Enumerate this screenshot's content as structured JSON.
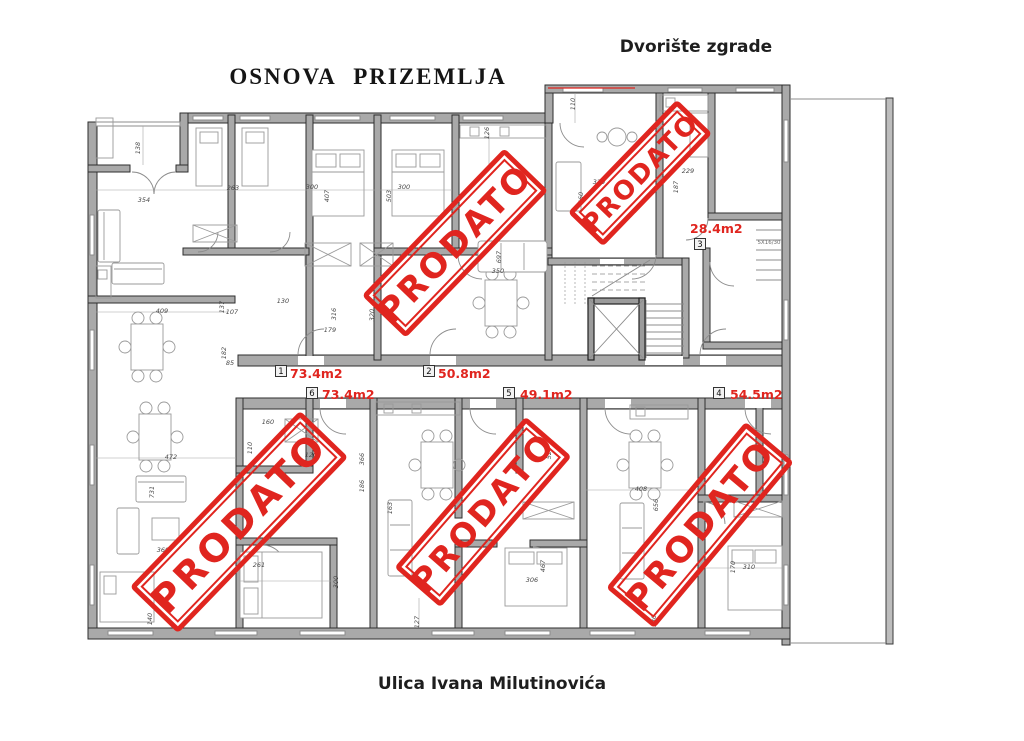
{
  "title": "OSNOVA PRIZEMLJA",
  "courtyard_label": "Dvorište zgrade",
  "street_label": "Ulica Ivana Milutinovića",
  "stamp_text": "PRODATO",
  "stair_note": "5X16/30",
  "colors": {
    "red": "#e0251f",
    "wall": "#a9a9a9",
    "wall_stroke": "#2e2e2e",
    "line": "#8c8c8c",
    "dim_text": "#4a4a4a"
  },
  "apartments": [
    {
      "num": "1",
      "area": "73.4m2",
      "sold": false,
      "box_x": 281,
      "box_y": 371,
      "text_x": 290,
      "text_y": 378
    },
    {
      "num": "2",
      "area": "50.8m2",
      "sold": true,
      "box_x": 429,
      "box_y": 371,
      "text_x": 438,
      "text_y": 378
    },
    {
      "num": "3",
      "area": "28.4m2",
      "sold": true,
      "box_x": 700,
      "box_y": 244,
      "text_x": 690,
      "text_y": 233
    },
    {
      "num": "4",
      "area": "54.5m2",
      "sold": true,
      "box_x": 719,
      "box_y": 393,
      "text_x": 730,
      "text_y": 399
    },
    {
      "num": "5",
      "area": "49.1m2",
      "sold": true,
      "box_x": 509,
      "box_y": 393,
      "text_x": 520,
      "text_y": 399
    },
    {
      "num": "6",
      "area": "73.4m2",
      "sold": true,
      "box_x": 312,
      "box_y": 393,
      "text_x": 322,
      "text_y": 399
    }
  ],
  "stamps": [
    {
      "apartment": "2",
      "x": 455,
      "y": 243,
      "rot": -46,
      "w": 200,
      "h": 56,
      "font": 34,
      "ls": 3
    },
    {
      "apartment": "3",
      "x": 640,
      "y": 173,
      "rot": -46,
      "w": 152,
      "h": 44,
      "font": 26,
      "ls": 2
    },
    {
      "apartment": "6",
      "x": 239,
      "y": 522,
      "rot": -46,
      "w": 240,
      "h": 62,
      "font": 38,
      "ls": 4
    },
    {
      "apartment": "5",
      "x": 483,
      "y": 512,
      "rot": -49,
      "w": 195,
      "h": 56,
      "font": 33,
      "ls": 3
    },
    {
      "apartment": "4",
      "x": 700,
      "y": 525,
      "rot": -50,
      "w": 212,
      "h": 58,
      "font": 35,
      "ls": 3
    }
  ],
  "dimensions": [
    {
      "t": "138",
      "x": 140,
      "y": 148,
      "r": -90
    },
    {
      "t": "354",
      "x": 144,
      "y": 202,
      "r": 0
    },
    {
      "t": "263",
      "x": 233,
      "y": 190,
      "r": 0
    },
    {
      "t": "300",
      "x": 312,
      "y": 189,
      "r": 0
    },
    {
      "t": "407",
      "x": 329,
      "y": 196,
      "r": -90
    },
    {
      "t": "503",
      "x": 391,
      "y": 196,
      "r": -90
    },
    {
      "t": "300",
      "x": 404,
      "y": 189,
      "r": 0
    },
    {
      "t": "126",
      "x": 489,
      "y": 133,
      "r": -90
    },
    {
      "t": "110",
      "x": 575,
      "y": 104,
      "r": -90
    },
    {
      "t": "320",
      "x": 599,
      "y": 184,
      "r": 0
    },
    {
      "t": "460",
      "x": 583,
      "y": 198,
      "r": -90
    },
    {
      "t": "229",
      "x": 688,
      "y": 173,
      "r": 0
    },
    {
      "t": "187",
      "x": 678,
      "y": 187,
      "r": -90
    },
    {
      "t": "130",
      "x": 283,
      "y": 303,
      "r": 0
    },
    {
      "t": "179",
      "x": 330,
      "y": 332,
      "r": 0
    },
    {
      "t": "316",
      "x": 336,
      "y": 314,
      "r": -90
    },
    {
      "t": "320",
      "x": 374,
      "y": 315,
      "r": -90
    },
    {
      "t": "137",
      "x": 224,
      "y": 307,
      "r": -90
    },
    {
      "t": "107",
      "x": 232,
      "y": 314,
      "r": 0
    },
    {
      "t": "409",
      "x": 162,
      "y": 313,
      "r": 0
    },
    {
      "t": "182",
      "x": 226,
      "y": 353,
      "r": -90
    },
    {
      "t": "85",
      "x": 230,
      "y": 365,
      "r": 0
    },
    {
      "t": "697",
      "x": 501,
      "y": 257,
      "r": -90
    },
    {
      "t": "350",
      "x": 498,
      "y": 273,
      "r": 0
    },
    {
      "t": "472",
      "x": 171,
      "y": 459,
      "r": 0
    },
    {
      "t": "731",
      "x": 154,
      "y": 492,
      "r": -90
    },
    {
      "t": "360",
      "x": 163,
      "y": 552,
      "r": 0
    },
    {
      "t": "140",
      "x": 152,
      "y": 619,
      "r": -90
    },
    {
      "t": "160",
      "x": 268,
      "y": 424,
      "r": 0
    },
    {
      "t": "110",
      "x": 252,
      "y": 448,
      "r": -90
    },
    {
      "t": "120",
      "x": 311,
      "y": 457,
      "r": 0
    },
    {
      "t": "261",
      "x": 259,
      "y": 567,
      "r": 0
    },
    {
      "t": "300",
      "x": 338,
      "y": 582,
      "r": -90
    },
    {
      "t": "127",
      "x": 419,
      "y": 622,
      "r": -90
    },
    {
      "t": "366",
      "x": 364,
      "y": 459,
      "r": -90
    },
    {
      "t": "186",
      "x": 364,
      "y": 486,
      "r": -90
    },
    {
      "t": "163",
      "x": 392,
      "y": 508,
      "r": -90
    },
    {
      "t": "306",
      "x": 532,
      "y": 582,
      "r": 0
    },
    {
      "t": "467",
      "x": 545,
      "y": 566,
      "r": -90
    },
    {
      "t": "520",
      "x": 551,
      "y": 453,
      "r": -90
    },
    {
      "t": "408",
      "x": 641,
      "y": 491,
      "r": 0
    },
    {
      "t": "656",
      "x": 658,
      "y": 505,
      "r": -90
    },
    {
      "t": "310",
      "x": 749,
      "y": 569,
      "r": 0
    },
    {
      "t": "170",
      "x": 735,
      "y": 567,
      "r": -90
    },
    {
      "t": "130",
      "x": 656,
      "y": 621,
      "r": -90
    }
  ]
}
